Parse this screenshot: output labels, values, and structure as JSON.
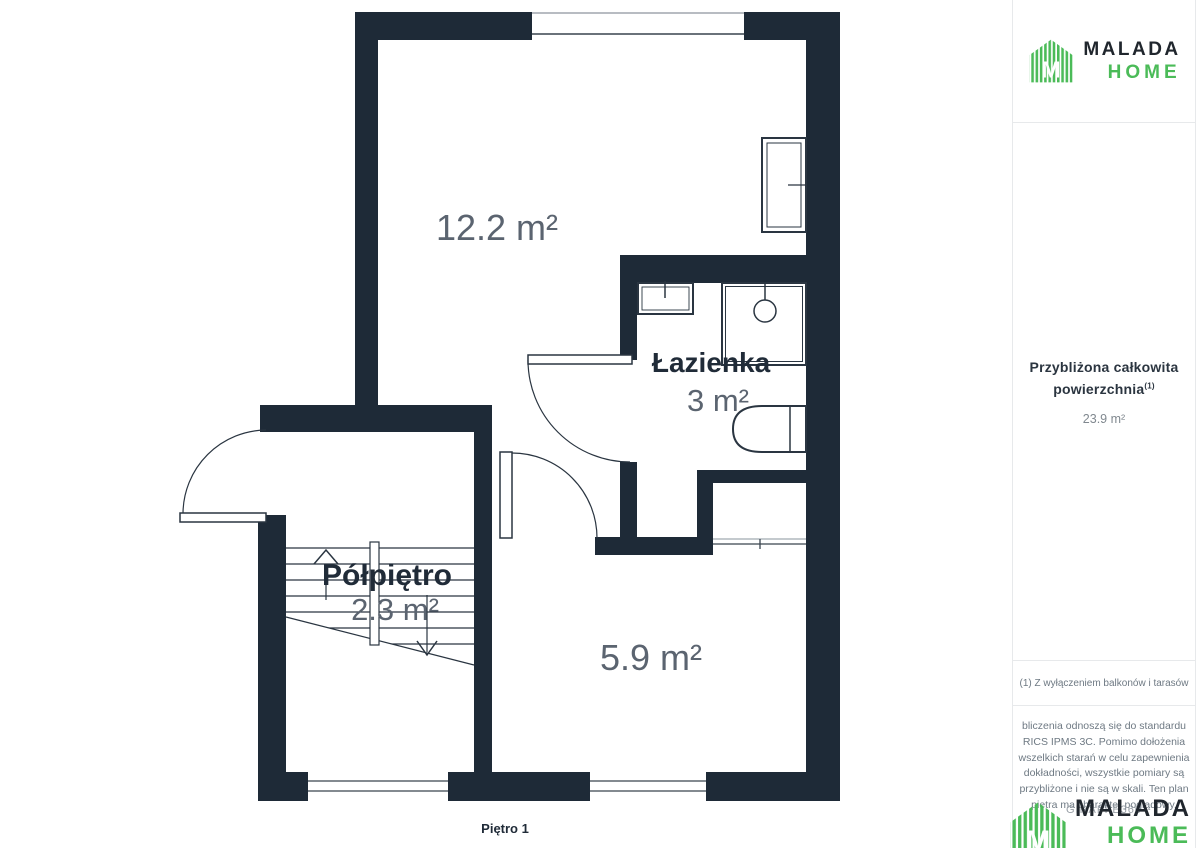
{
  "brand": {
    "primary": "MALADA",
    "secondary": "HOME"
  },
  "sidebar": {
    "summary_title_line1": "Przybliżona całkowita",
    "summary_title_line2": "powierzchnia",
    "summary_sup": "(1)",
    "summary_value": "23.9 m²",
    "footnote": "(1) Z wyłączeniem balkonów i tarasów",
    "disclaimer_lines": [
      "bliczenia odnoszą się do standardu",
      "RICS IPMS 3C. Pomimo dołożenia",
      "wszelkich starań w celu zapewnienia",
      "dokładności, wszystkie pomiary są",
      "przybliżone i nie są w skali. Ten plan",
      "piętra ma charakter poglądowy."
    ],
    "watermark": "GIRAFFE360"
  },
  "floorplan": {
    "floor_label": "Piętro 1",
    "room_top_area": "12.2 m²",
    "bathroom_name": "Łazienka",
    "bathroom_area": "3 m²",
    "landing_name": "Półpiętro",
    "landing_area": "2.3 m²",
    "room_bottom_area": "5.9 m²"
  },
  "colors": {
    "wall": "#1e2a37",
    "accent_green": "#4bbb58",
    "area_text": "#5b6470",
    "name_text": "#202b38"
  }
}
